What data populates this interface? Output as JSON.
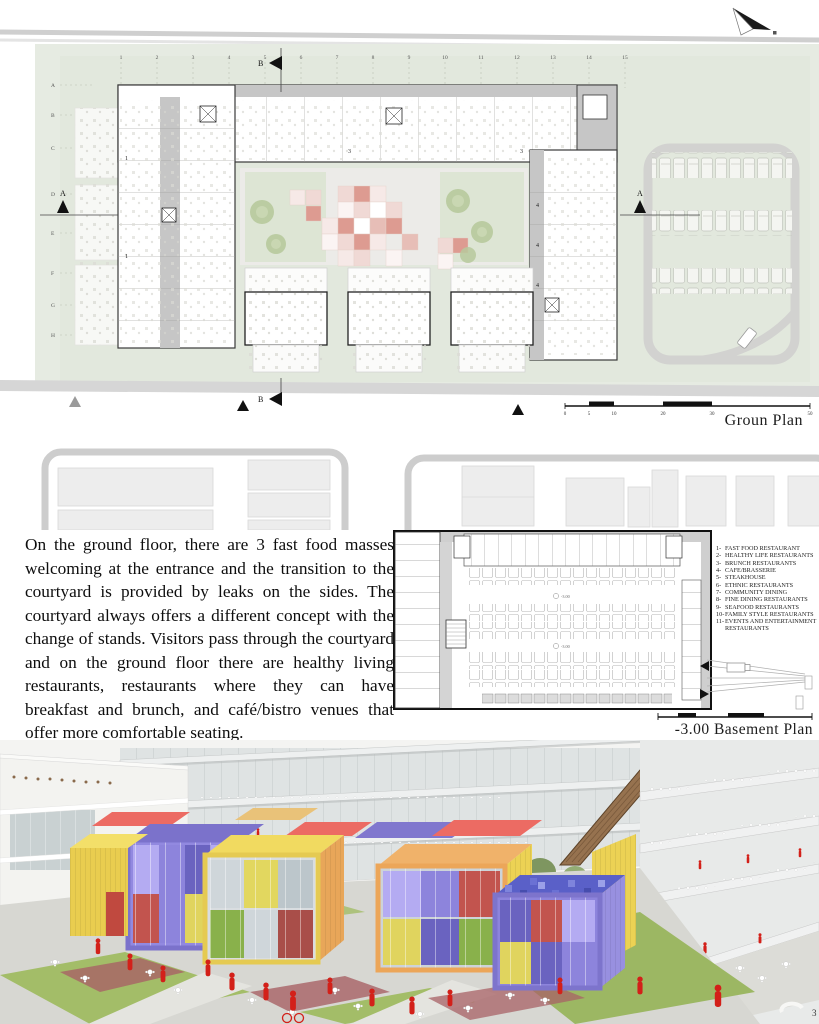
{
  "page": {
    "number": "3"
  },
  "ground_plan": {
    "label": "Groun Plan",
    "grid_numbers": [
      "1",
      "2",
      "3",
      "4",
      "5",
      "6",
      "7",
      "8",
      "9",
      "10",
      "11",
      "12",
      "13",
      "14",
      "15"
    ],
    "grid_letters": [
      "A",
      "B",
      "C",
      "D",
      "E",
      "F",
      "G",
      "H"
    ],
    "section_marker_a": "A",
    "section_marker_b": "B",
    "unit_labels": [
      "1",
      "3",
      "4"
    ],
    "scale_labels": [
      "0",
      "5",
      "10",
      "20",
      "30",
      "50"
    ]
  },
  "description": {
    "text": "On the ground floor, there are 3 fast food masses welcoming at the entrance and the transition to the courtyard is provided by leaks on the sides. The courtyard always offers a different concept with the change of stands. Visitors pass through the courtyard and on the ground floor there are healthy living restaurants, restaurants where they can have breakfast and brunch, and café/bistro venues that offer more comfortable seating."
  },
  "basement_plan": {
    "label": "-3.00 Basement Plan",
    "elevation_mark": "-3.00",
    "legend": {
      "items": [
        {
          "num": "1-",
          "label": "FAST FOOD RESTAURANT"
        },
        {
          "num": "2-",
          "label": "HEALTHY LIFE RESTAURANTS"
        },
        {
          "num": "3-",
          "label": "BRUNCH RESTAURANTS"
        },
        {
          "num": "4-",
          "label": "CAFE/BRASSERIE"
        },
        {
          "num": "5-",
          "label": "STEAKHOUSE"
        },
        {
          "num": "6-",
          "label": "ETHNIC RESTAURANTS"
        },
        {
          "num": "7-",
          "label": "COMMUNITY DINING"
        },
        {
          "num": "8-",
          "label": "FINE DINING RESTAURANTS"
        },
        {
          "num": "9-",
          "label": "SEAFOOD RESTAURANTS"
        },
        {
          "num": "10-",
          "label": "FAMILY STYLE RESTAURANTS"
        },
        {
          "num": "11-",
          "label": "EVENTS AND ENTERTAINMENT RESTAURANTS"
        }
      ]
    }
  },
  "colors": {
    "site_green": "#e6ebe2",
    "mosaic_pink": "#dd9b91",
    "cube_yellow": "#ecd254",
    "cube_purple": "#7b72cb",
    "cube_red": "#ec6b63",
    "cube_orange": "#efae64",
    "cube_blue": "#5a60c8",
    "figure_red": "#d32019"
  }
}
